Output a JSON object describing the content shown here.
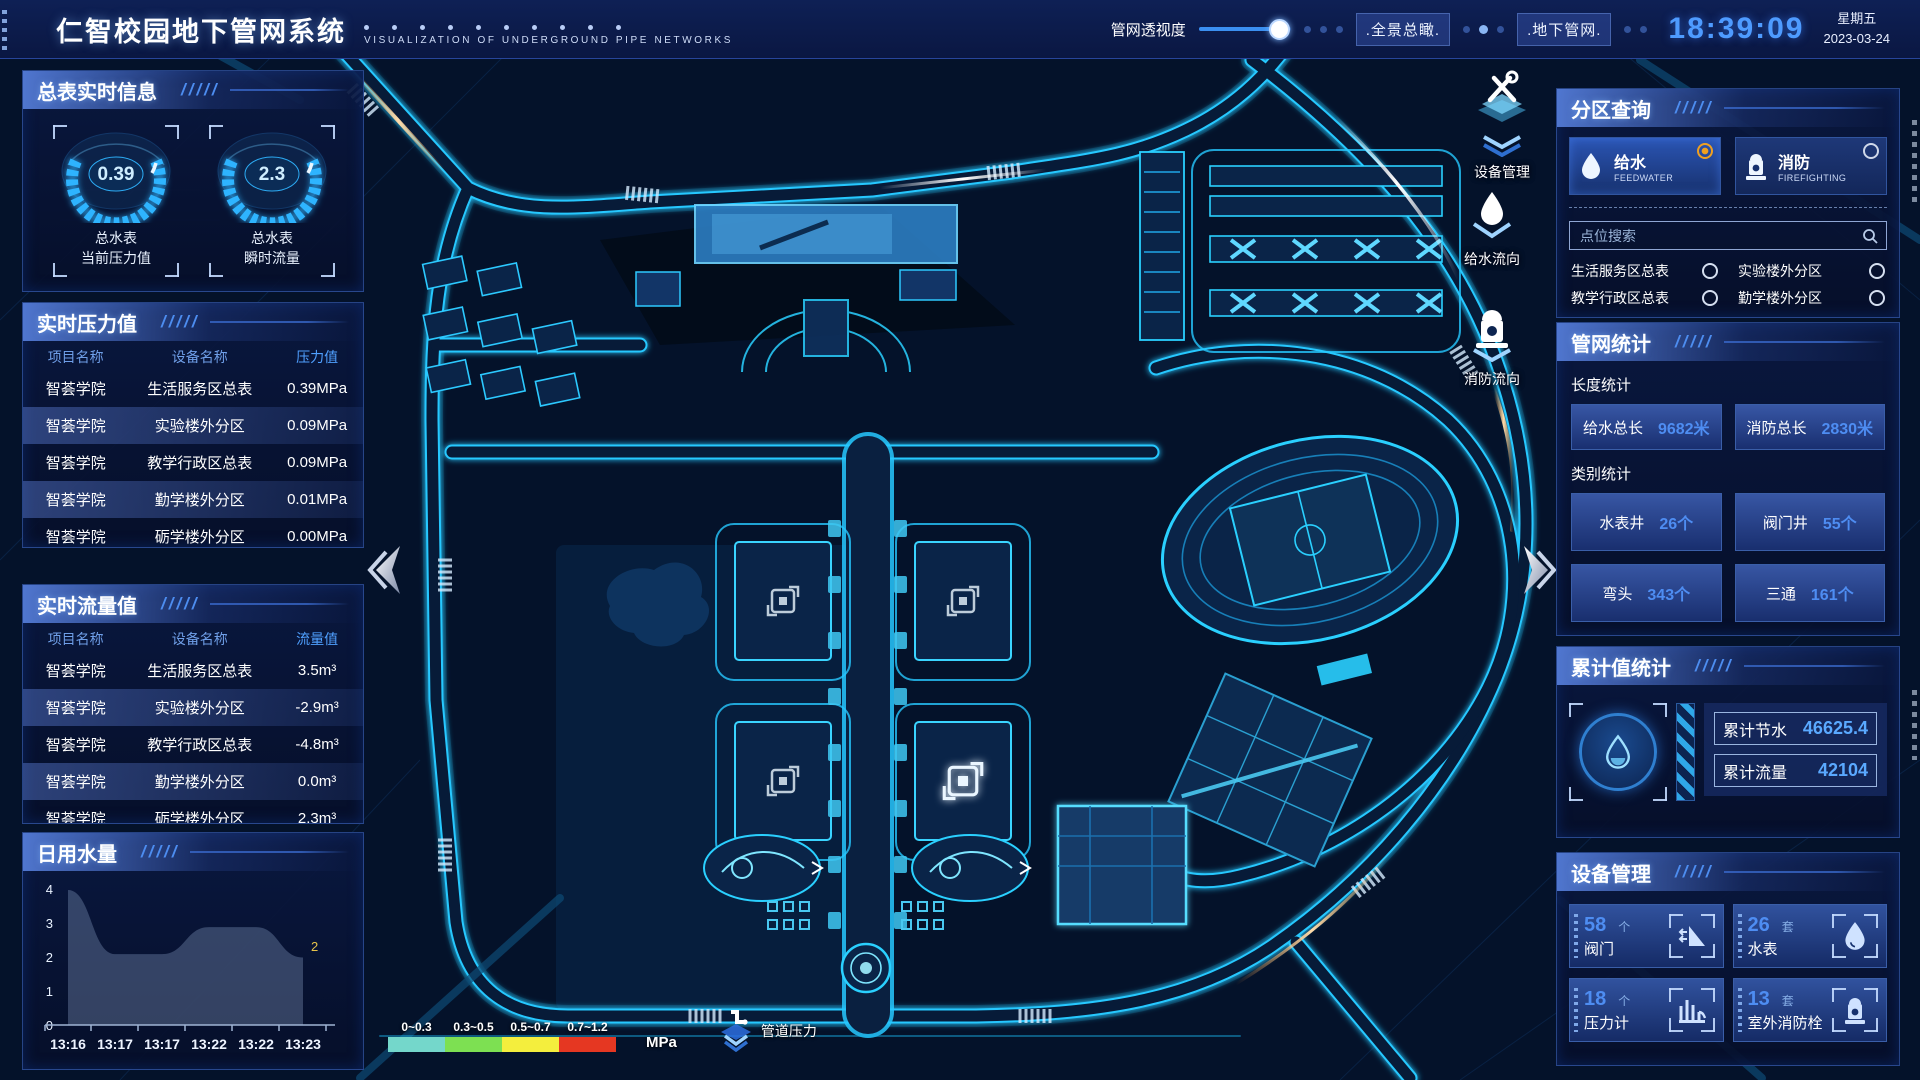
{
  "header": {
    "title": "仁智校园地下管网系统",
    "subtitle": "VISUALIZATION OF UNDERGROUND PIPE NETWORKS",
    "opacity_label": "管网透视度",
    "buttons": [
      {
        "label": ".全景总瞰."
      },
      {
        "label": ".地下管网."
      }
    ],
    "time": "18:39:09",
    "weekday": "星期五",
    "date": "2023-03-24"
  },
  "gauges": {
    "section_title": "总表实时信息",
    "items": [
      {
        "value": "0.39",
        "label_line1": "总水表",
        "label_line2": "当前压力值"
      },
      {
        "value": "2.3",
        "label_line1": "总水表",
        "label_line2": "瞬时流量"
      }
    ]
  },
  "pressure": {
    "section_title": "实时压力值",
    "headers": [
      "项目名称",
      "设备名称",
      "压力值"
    ],
    "rows": [
      {
        "project": "智荟学院",
        "device": "生活服务区总表",
        "value": "0.39MPa"
      },
      {
        "project": "智荟学院",
        "device": "实验楼外分区",
        "value": "0.09MPa"
      },
      {
        "project": "智荟学院",
        "device": "教学行政区总表",
        "value": "0.09MPa"
      },
      {
        "project": "智荟学院",
        "device": "勤学楼外分区",
        "value": "0.01MPa"
      },
      {
        "project": "智荟学院",
        "device": "砺学楼外分区",
        "value": "0.00MPa"
      }
    ]
  },
  "flow": {
    "section_title": "实时流量值",
    "headers": [
      "项目名称",
      "设备名称",
      "流量值"
    ],
    "rows": [
      {
        "project": "智荟学院",
        "device": "生活服务区总表",
        "value": "3.5m³"
      },
      {
        "project": "智荟学院",
        "device": "实验楼外分区",
        "value": "-2.9m³"
      },
      {
        "project": "智荟学院",
        "device": "教学行政区总表",
        "value": "-4.8m³"
      },
      {
        "project": "智荟学院",
        "device": "勤学楼外分区",
        "value": "0.0m³"
      },
      {
        "project": "智荟学院",
        "device": "砺学楼外分区",
        "value": "2.3m³"
      }
    ]
  },
  "daily_water": {
    "section_title": "日用水量",
    "y_ticks": [
      4,
      3,
      2,
      1,
      0
    ],
    "x_labels": [
      "13:16",
      "13:17",
      "13:17",
      "13:22",
      "13:22",
      "13:23"
    ],
    "values": [
      4,
      2.1,
      2.1,
      2.9,
      2.9,
      2
    ],
    "end_label": "2"
  },
  "partition": {
    "section_title": "分区查询",
    "tabs": [
      {
        "label": "给水",
        "sub": "FEEDWATER",
        "selected": true
      },
      {
        "label": "消防",
        "sub": "FIREFIGHTING",
        "selected": false
      }
    ],
    "search_placeholder": "点位搜索",
    "items": [
      "生活服务区总表",
      "实验楼外分区",
      "教学行政区总表",
      "勤学楼外分区",
      "砺学楼外分区",
      "宿舍区泵房"
    ]
  },
  "pipe_stats": {
    "section_title": "管网统计",
    "length_title": "长度统计",
    "length_items": [
      {
        "label": "给水总长",
        "value": "9682米"
      },
      {
        "label": "消防总长",
        "value": "2830米"
      }
    ],
    "category_title": "类别统计",
    "category_items": [
      {
        "label": "水表井",
        "value": "26个"
      },
      {
        "label": "阀门井",
        "value": "55个"
      },
      {
        "label": "弯头",
        "value": "343个"
      },
      {
        "label": "三通",
        "value": "161个"
      }
    ]
  },
  "cumulative": {
    "section_title": "累计值统计",
    "items": [
      {
        "label": "累计节水",
        "value": "46625.4"
      },
      {
        "label": "累计流量",
        "value": "42104"
      }
    ]
  },
  "devices": {
    "section_title": "设备管理",
    "items": [
      {
        "count": "58",
        "unit": "个",
        "label": "阀门",
        "icon": "valve-icon"
      },
      {
        "count": "26",
        "unit": "套",
        "label": "水表",
        "icon": "water-meter-icon"
      },
      {
        "count": "18",
        "unit": "个",
        "label": "压力计",
        "icon": "pressure-gauge-icon"
      },
      {
        "count": "13",
        "unit": "套",
        "label": "室外消防栓",
        "icon": "hydrant-icon"
      }
    ]
  },
  "map": {
    "float_tools": [
      "设备管理",
      "给水流向",
      "消防流向"
    ],
    "legend": {
      "ranges": [
        {
          "label": "0~0.3",
          "color": "#74d7cb"
        },
        {
          "label": "0.3~0.5",
          "color": "#7de052"
        },
        {
          "label": "0.5~0.7",
          "color": "#f4ee3d"
        },
        {
          "label": "0.7~1.2",
          "color": "#e53722"
        }
      ],
      "unit": "MPa",
      "pressure_label": "管道压力"
    }
  }
}
